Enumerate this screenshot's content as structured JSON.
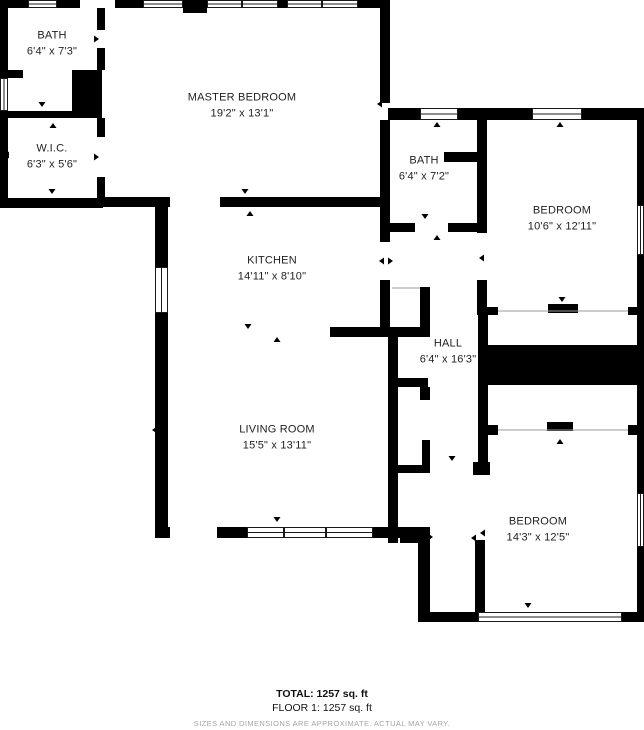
{
  "floorplan": {
    "rooms": {
      "bath1": {
        "name": "BATH",
        "dims": "6'4\" x 7'3\""
      },
      "wic": {
        "name": "W.I.C.",
        "dims": "6'3\" x 5'6\""
      },
      "master": {
        "name": "MASTER BEDROOM",
        "dims": "19'2\" x 13'1\""
      },
      "bath2": {
        "name": "BATH",
        "dims": "6'4\" x 7'2\""
      },
      "bedroom1": {
        "name": "BEDROOM",
        "dims": "10'6\" x 12'11\""
      },
      "kitchen": {
        "name": "KITCHEN",
        "dims": "14'11\" x 8'10\""
      },
      "hall": {
        "name": "HALL",
        "dims": "6'4\" x 16'3\""
      },
      "living": {
        "name": "LIVING ROOM",
        "dims": "15'5\" x 13'11\""
      },
      "bedroom2": {
        "name": "BEDROOM",
        "dims": "14'3\" x 12'5\""
      }
    },
    "summary": {
      "total": "TOTAL: 1257 sq. ft",
      "floor": "FLOOR 1: 1257 sq. ft",
      "disclaimer": "SIZES AND DIMENSIONS ARE APPROXIMATE. ACTUAL MAY VARY."
    },
    "colors": {
      "wall": "#000000",
      "background": "#ffffff",
      "label_text": "#1f1f1f",
      "disclaimer_text": "#a5a5a5"
    }
  }
}
